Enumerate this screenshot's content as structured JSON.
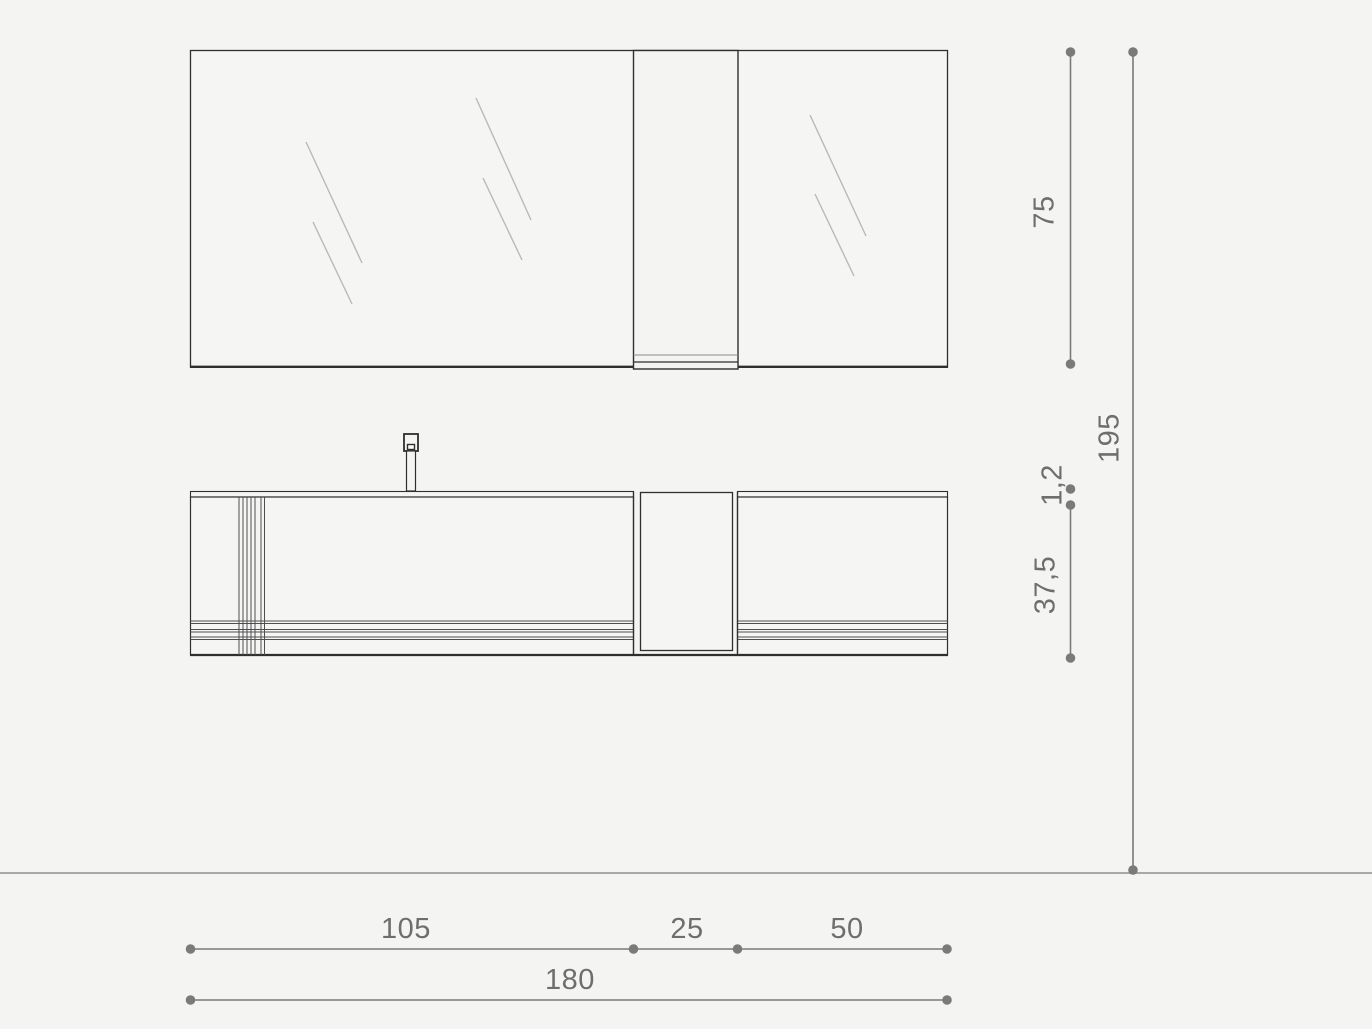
{
  "dimensions": {
    "vertical": [
      {
        "id": "mirror_height",
        "label": "75"
      },
      {
        "id": "total_height",
        "label": "195"
      },
      {
        "id": "countertop_thickness",
        "label": "1,2"
      },
      {
        "id": "cabinet_height",
        "label": "37,5"
      }
    ],
    "horizontal": [
      {
        "id": "left_section_width",
        "label": "105"
      },
      {
        "id": "niche_width",
        "label": "25"
      },
      {
        "id": "right_section_width",
        "label": "50"
      },
      {
        "id": "total_width",
        "label": "180"
      }
    ]
  },
  "colors": {
    "background": "#f4f4f3",
    "outline": "#2f2f2f",
    "detail_line": "#4f4f4f",
    "glass_shine": "#b9b9b9",
    "dimension": "#7a7a7a",
    "dimension_text": "#6e6e6e",
    "floor_line": "#a8a8a8"
  }
}
